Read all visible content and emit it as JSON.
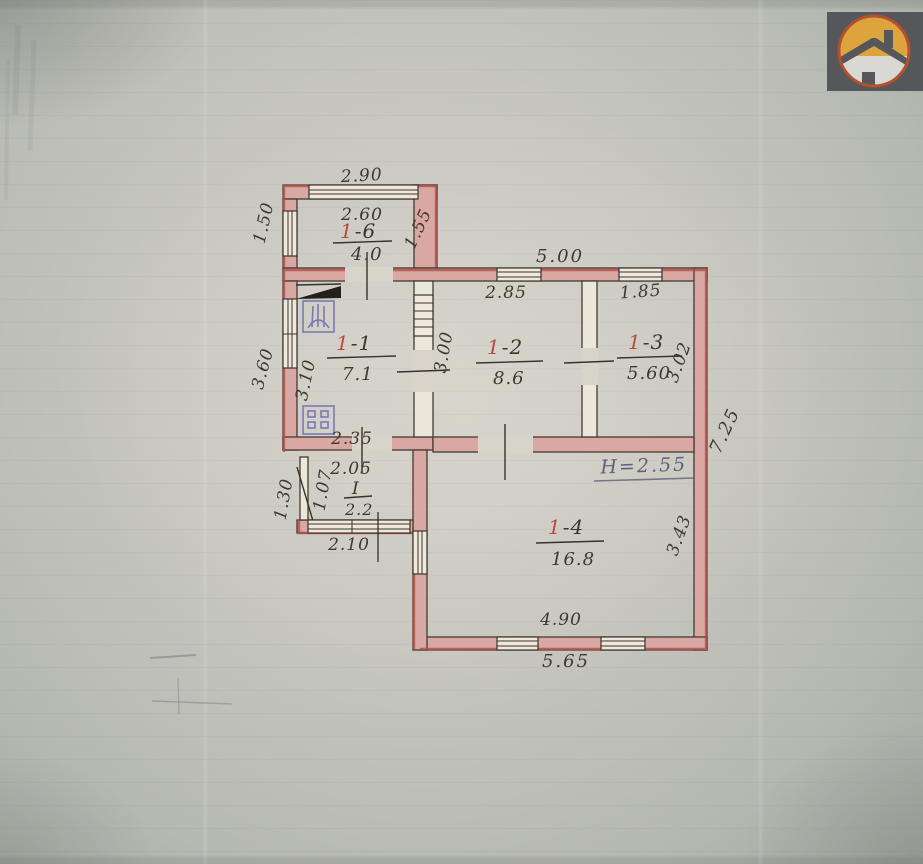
{
  "document_type": "scanned-floor-plan",
  "palette": {
    "paper": "#c6c6bf",
    "wall_fill": "#d9a8a2",
    "wall_accent_red": "#b0504a",
    "ink": "#3b352c",
    "room_number_red": "#b84a41",
    "pencil_note": "#5d6178",
    "symbol_blue": "#7b79b4",
    "logo_bg": "#56575b",
    "logo_ring": "#b5502f",
    "logo_amber": "#dda43e"
  },
  "logo": {
    "icon": "house-in-circle-icon"
  },
  "rooms": [
    {
      "num": "1",
      "rest": "-6",
      "area": "4.0"
    },
    {
      "num": "1",
      "rest": "-1",
      "area": "7.1"
    },
    {
      "num": "1",
      "rest": "-2",
      "area": "8.6"
    },
    {
      "num": "1",
      "rest": "-3",
      "area": "5.60"
    },
    {
      "num": "1",
      "rest": "-4",
      "area": "16.8"
    },
    {
      "num": "I",
      "rest": "",
      "area": "2.2"
    }
  ],
  "dims": {
    "porch_top_out": "2.90",
    "porch_top_in": "2.60",
    "porch_left": "1.50",
    "porch_right": "1.55",
    "top_out": "5.00",
    "r12_top": "2.85",
    "r13_top": "1.85",
    "r12_left": "3.00",
    "r13_right": "3.02",
    "r11_left_out": "3.60",
    "r11_left_in": "3.10",
    "r11_bottom": "2.35",
    "hall_top": "2.05",
    "hall_left_in": "1.07",
    "hall_left_out": "1.30",
    "hall_bottom": "2.10",
    "right_out": "7.25",
    "r14_right": "3.43",
    "r14_bottom": "4.90",
    "bottom_out": "5.65"
  },
  "notes": {
    "height": "H=2.55"
  }
}
